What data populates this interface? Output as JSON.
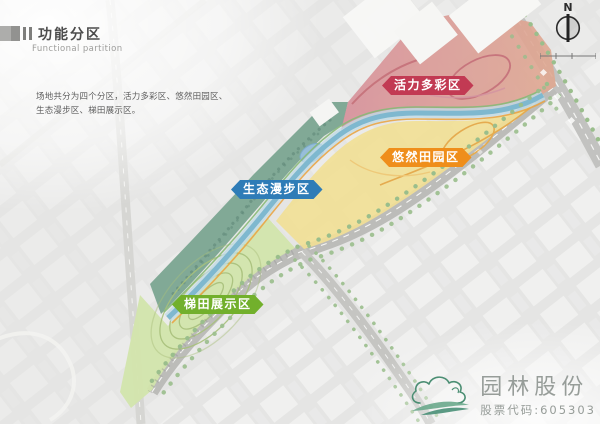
{
  "header": {
    "title": "功能分区",
    "subtitle": "Functional partition",
    "description_line1": "场地共分为四个分区，活力多彩区、悠然田园区、",
    "description_line2": "生态漫步区、梯田展示区。"
  },
  "compass": {
    "north_label": "N"
  },
  "map": {
    "zone_labels": [
      {
        "id": "vitality",
        "label": "活力多彩区",
        "color": "#c23a53"
      },
      {
        "id": "pastoral",
        "label": "悠然田园区",
        "color": "#ef8e1b"
      },
      {
        "id": "eco-stroll",
        "label": "生态漫步区",
        "color": "#2e7cb7"
      },
      {
        "id": "terrace",
        "label": "梯田展示区",
        "color": "#72b02c"
      }
    ],
    "palette": {
      "zone_vitality_fill": "#d4868f",
      "zone_vitality_fill_2": "#dc9f85",
      "zone_pastoral_fill": "#f0dc8a",
      "zone_eco_fill": "#6d9c86",
      "zone_terrace_fill": "#cde2a2",
      "river": "#71b0ca",
      "road": "#b5b5b2",
      "street_trees": "#8fb77f"
    }
  },
  "logo": {
    "company_name": "园林股份",
    "stock_code_line": "股票代码:605303"
  }
}
